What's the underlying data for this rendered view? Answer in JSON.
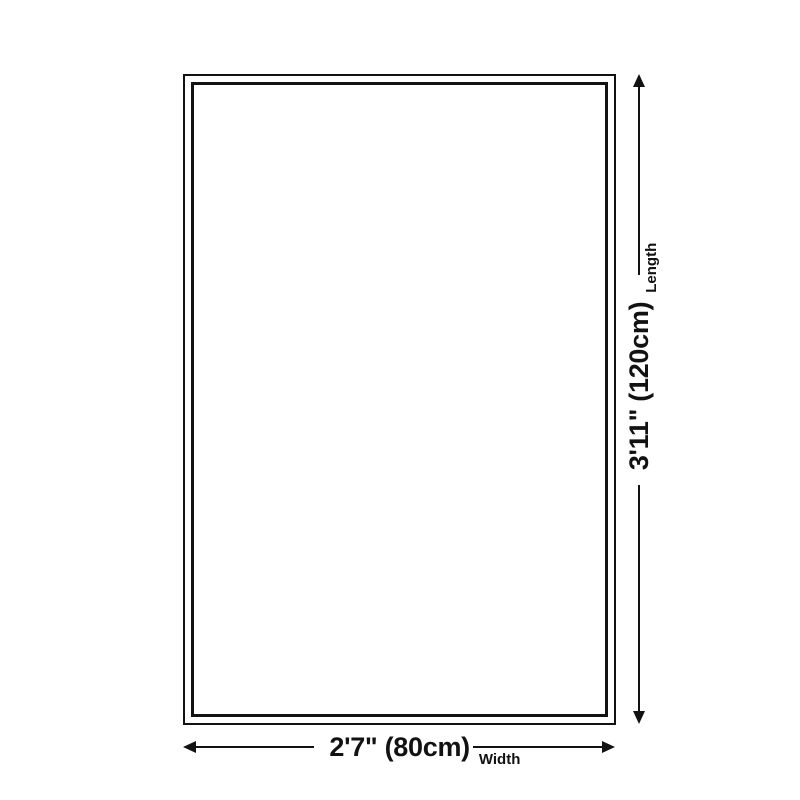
{
  "diagram": {
    "length": {
      "value": "3'11\" (120cm)",
      "label": "Length"
    },
    "width": {
      "value": "2'7\" (80cm)",
      "label": "Width"
    },
    "colors": {
      "line": "#121212",
      "background": "#ffffff"
    }
  }
}
